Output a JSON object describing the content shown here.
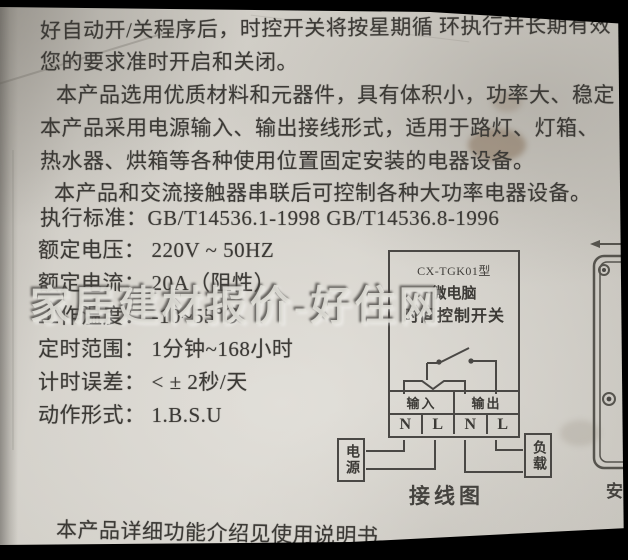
{
  "content": {
    "lines": [
      "好自动开/关程序后，时控开关将按星期循 环执行并长期有效",
      "您的要求准时开启和关闭。",
      "本产品选用优质材料和元器件，具有体积小，功率大、稳定",
      "本产品采用电源输入、输出接线形式，适用于路灯、灯箱、",
      "热水器、烘箱等各种使用位置固定安装的电器设备。",
      "本产品和交流接触器串联后可控制各种大功率电器设备。",
      "执行标准：GB/T14536.1-1998  GB/T14536.8-1996"
    ],
    "specs": [
      {
        "label": "额定电压：",
        "value": "220V ~ 50HZ"
      },
      {
        "label": "额定电流：",
        "value": "20A（阻性）"
      },
      {
        "label": "工作温度：",
        "value": "-10~55℃"
      },
      {
        "label": "定时范围：",
        "value": "1分钟~168小时"
      },
      {
        "label": "计时误差：",
        "value": "< ± 2秒/天"
      },
      {
        "label": "动作形式：",
        "value": "1.B.S.U"
      }
    ],
    "footer": "本产品详细功能介绍见使用说明书"
  },
  "watermark": {
    "text": "家居建材报价-好住网"
  },
  "diagram": {
    "model": "CX-TGK01型",
    "device_line1": "微电脑",
    "device_line2": "时间控制开关",
    "input_label": "输入",
    "output_label": "输出",
    "terminals": [
      "N",
      "L",
      "N",
      "L"
    ],
    "power_label": "电源",
    "load_label": "负载",
    "caption": "接线图"
  },
  "install_diagram": {
    "partial_caption": "安"
  },
  "colors": {
    "paper": "#cfccc5",
    "ink": "#3c3a36",
    "diagram_line": "#4a4845",
    "border": "#000000"
  }
}
